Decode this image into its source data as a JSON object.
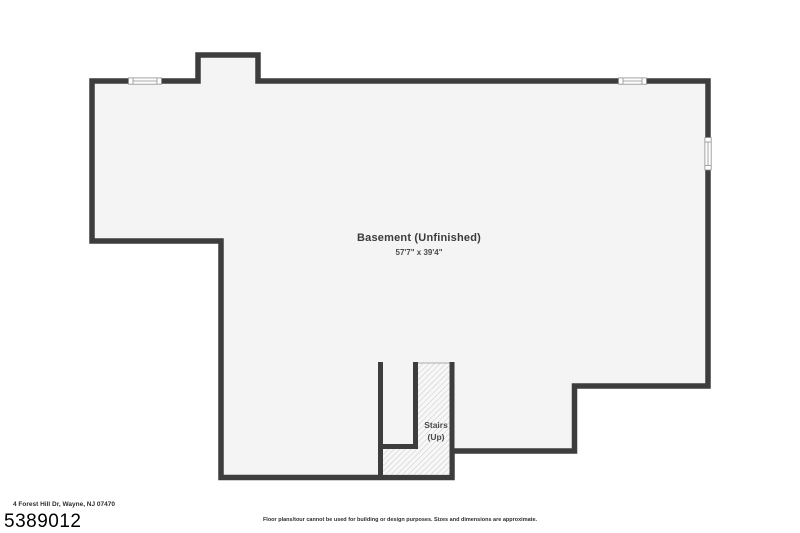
{
  "floor_plan": {
    "room_label": "Basement (Unfinished)",
    "room_dimensions": "57'7\" x 39'4\"",
    "stairs_label": {
      "line1": "Stairs",
      "line2": "(Up)"
    },
    "colors": {
      "wall": "#3d3d3d",
      "floor": "#f4f4f4",
      "hatch_line": "#c9c9c9",
      "hatch_background": "#f7f7f7",
      "window_frame": "#909090",
      "background": "#ffffff"
    }
  },
  "footer": {
    "address": "4 Forest Hill Dr, Wayne, NJ 07470",
    "listing_number": "5389012",
    "disclaimer": "Floor plans/tour cannot be used for building or design purposes. Sizes and dimensions are approximate."
  }
}
